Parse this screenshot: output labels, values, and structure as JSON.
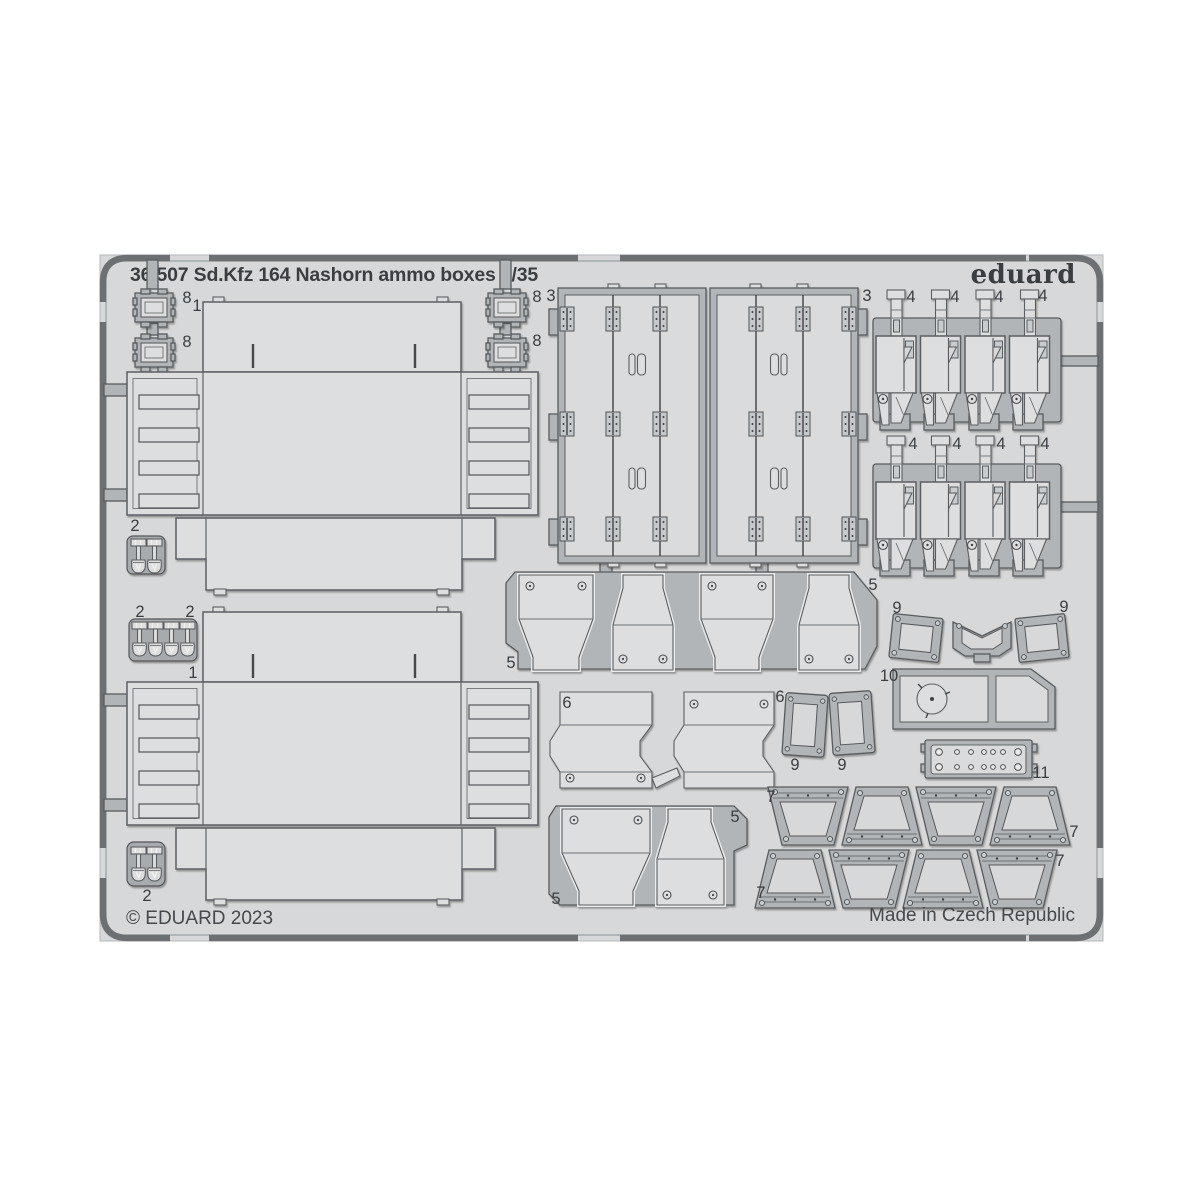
{
  "header": {
    "title": "36 507 Sd.Kfz 164 Nashorn ammo boxes 1/35",
    "brand": "eduard"
  },
  "footer": {
    "copyright": "© EDUARD 2023",
    "made_in": "Made in Czech Republic"
  },
  "colors": {
    "background": "#ffffff",
    "sheet": "#d6d8d9",
    "part_fill": "#dcdedf",
    "part_outline": "#5b5f62",
    "web_fill": "#b2b5b8",
    "frame_dark": "#6d7073",
    "label_text": "#3b3e41"
  },
  "labels": {
    "p8_a": "8",
    "p8_b": "8",
    "p8_c": "8",
    "p8_d": "8",
    "p1_a": "1",
    "p1_b": "1",
    "p2_a": "2",
    "p2_b": "2",
    "p2_c": "2",
    "p2_d": "2",
    "p3_a": "3",
    "p3_b": "3",
    "p4_a1": "4",
    "p4_a2": "4",
    "p4_a3": "4",
    "p4_a4": "4",
    "p4_b1": "4",
    "p4_b2": "4",
    "p4_b3": "4",
    "p4_b4": "4",
    "p5_a": "5",
    "p5_b": "5",
    "p5_c": "5",
    "p5_d": "5",
    "p6_a": "6",
    "p6_b": "6",
    "p7_a": "7",
    "p7_b": "7",
    "p7_c": "7",
    "p7_d": "7",
    "p9_a": "9",
    "p9_b": "9",
    "p9_c": "9",
    "p9_d": "9",
    "p10": "10",
    "p11": "11"
  }
}
